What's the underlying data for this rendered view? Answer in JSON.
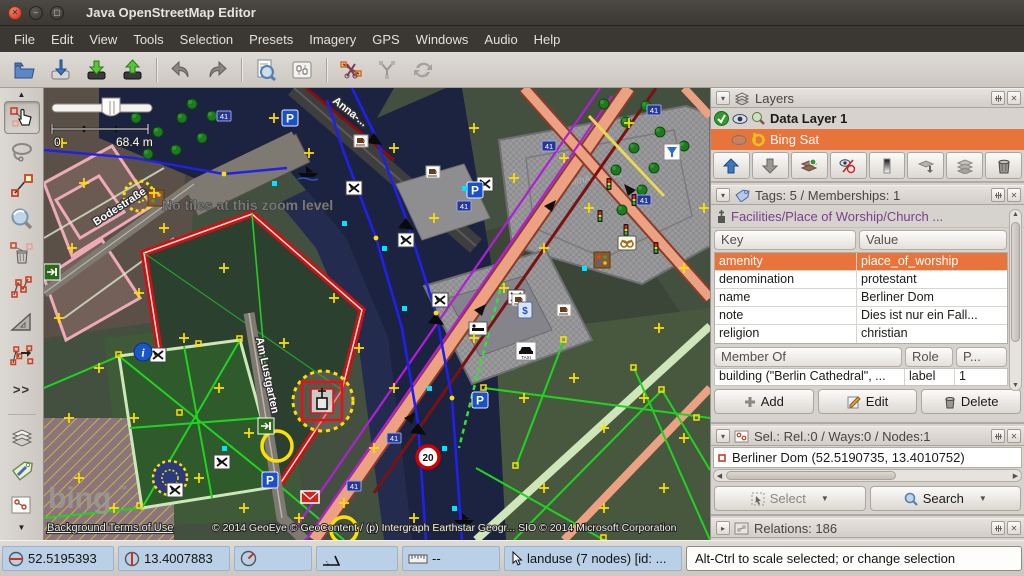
{
  "window": {
    "title": "Java OpenStreetMap Editor"
  },
  "menu": {
    "items": [
      "File",
      "Edit",
      "View",
      "Tools",
      "Selection",
      "Presets",
      "Imagery",
      "GPS",
      "Windows",
      "Audio",
      "Help"
    ]
  },
  "left_toolbar": {
    "more_label": ">>"
  },
  "map": {
    "scale_zero": "0",
    "scale_label": "68.4 m",
    "no_tiles_message": "No tiles at this zoom level",
    "street_bodestrasse": "Bodestraße",
    "street_am_lustgarten": "Am Lustgarten",
    "street_anna": "Anna-...",
    "building_label": "DomAquarée",
    "house_number": "41",
    "speed_sign": "20",
    "parking_letter": "P",
    "taxi_label": "TAXI",
    "atm_label": "$",
    "info_label": "i",
    "bing_logo": "bing",
    "bing_tm": "™",
    "terms_link": "Background Terms of Use",
    "copyright": "© 2014 GeoEye © GeoContent / (p) Intergraph Earthstar Geogr...  SIO © 2014 Microsoft Corporation"
  },
  "layers_panel": {
    "title": "Layers",
    "layers": [
      {
        "name": "Data Layer 1"
      },
      {
        "name": "Bing Sat"
      }
    ]
  },
  "tags_panel": {
    "title": "Tags: 5 / Memberships: 1",
    "preset": "Facilities/Place of Worship/Church ...",
    "key_header": "Key",
    "value_header": "Value",
    "tags": [
      {
        "key": "amenity",
        "value": "place_of_worship"
      },
      {
        "key": "denomination",
        "value": "protestant"
      },
      {
        "key": "name",
        "value": "Berliner Dom"
      },
      {
        "key": "note",
        "value": "Dies ist nur ein Fall..."
      },
      {
        "key": "religion",
        "value": "christian"
      }
    ],
    "member_header": "Member Of",
    "role_header": "Role",
    "position_header": "P...",
    "memberships": [
      {
        "member": "building (\"Berlin Cathedral\", ...",
        "role": "label",
        "position": "1"
      }
    ],
    "add_label": "Add",
    "edit_label": "Edit",
    "delete_label": "Delete"
  },
  "selection_panel": {
    "title": "Sel.: Rel.:0 / Ways:0 / Nodes:1",
    "items": [
      {
        "label": "Berliner Dom (52.5190735, 13.4010752)"
      }
    ],
    "select_label": "Select",
    "search_label": "Search"
  },
  "relations_panel": {
    "title": "Relations: 186"
  },
  "statusbar": {
    "lat": "52.5195393",
    "lon": "13.4007883",
    "distance": "--",
    "object_info": "landuse (7 nodes) [id: ...",
    "help": "Alt-Ctrl to scale selected; or change selection"
  }
}
